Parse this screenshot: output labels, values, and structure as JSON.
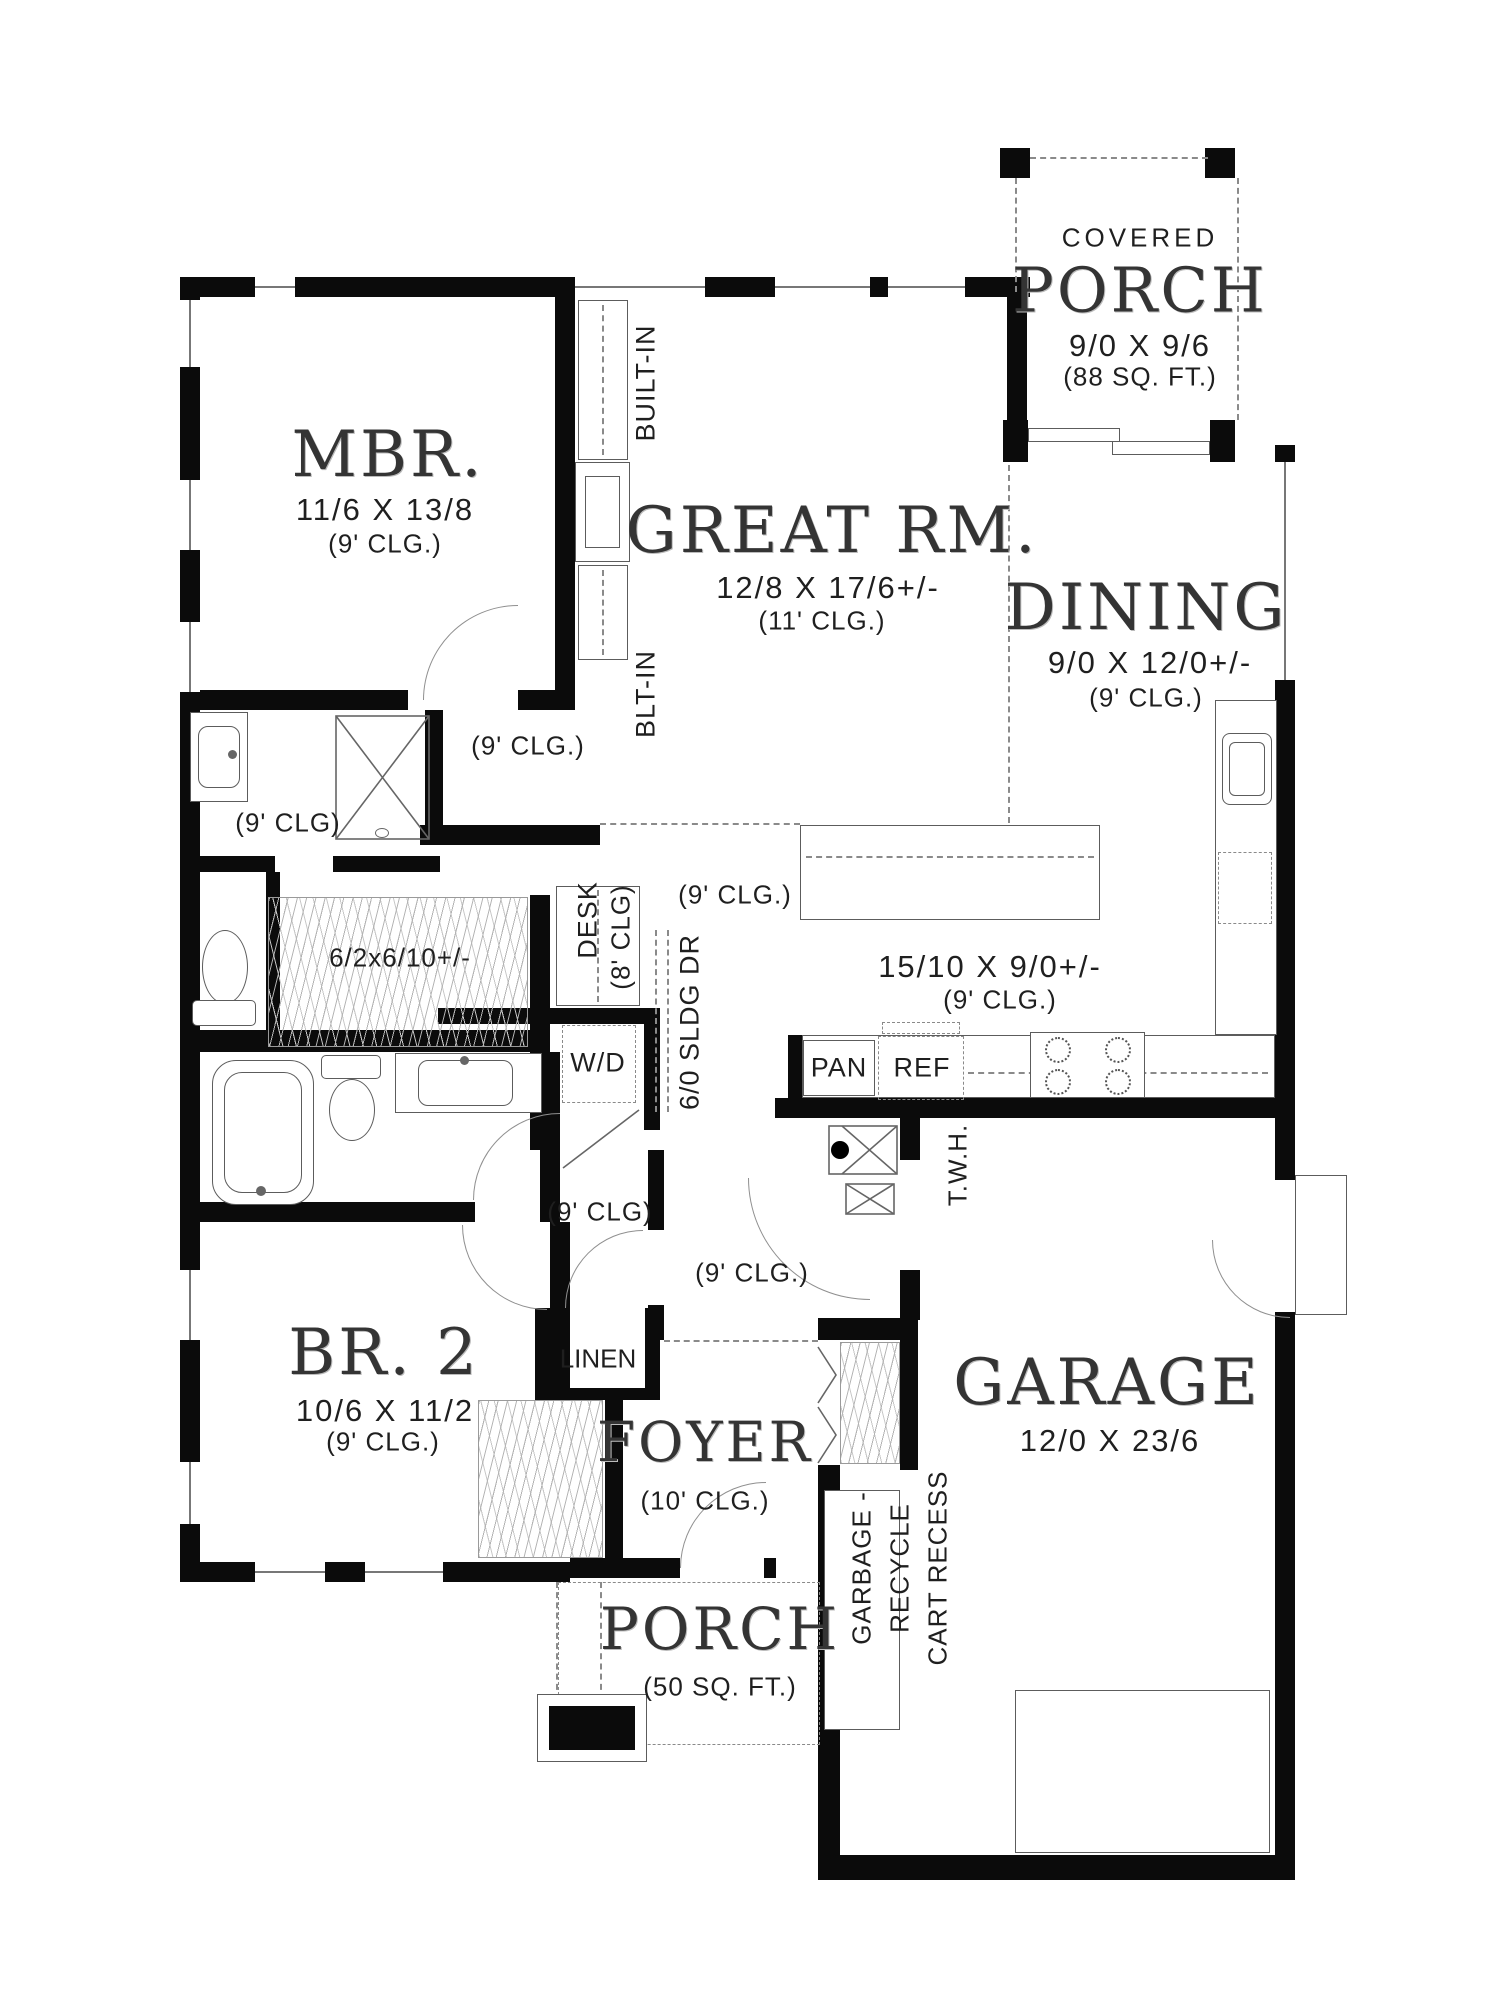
{
  "plan": {
    "type": "architectural-floor-plan",
    "rooms": {
      "covered_porch": {
        "label_top": "COVERED",
        "name": "PORCH",
        "dims": "9/0 X 9/6",
        "area": "(88 SQ. FT.)"
      },
      "mbr": {
        "name": "MBR.",
        "dims": "11/6 X 13/8",
        "clg": "(9' CLG.)"
      },
      "great_rm": {
        "name": "GREAT RM.",
        "dims": "12/8 X 17/6+/-",
        "clg": "(11' CLG.)"
      },
      "dining": {
        "name": "DINING",
        "dims": "9/0 X 12/0+/-",
        "clg": "(9' CLG.)"
      },
      "kitchen": {
        "dims": "15/10 X 9/0+/-",
        "clg": "(9' CLG.)"
      },
      "br2": {
        "name": "BR. 2",
        "dims": "10/6 X 11/2",
        "clg": "(9' CLG.)"
      },
      "foyer": {
        "name": "FOYER",
        "clg": "(10' CLG.)"
      },
      "garage": {
        "name": "GARAGE",
        "dims": "12/0 X 23/6"
      },
      "porch": {
        "name": "PORCH",
        "area": "(50 SQ. FT.)"
      }
    },
    "labels": {
      "built_in": "BUILT-IN",
      "blt_in": "BLT-IN",
      "desk": "DESK",
      "desk_clg": "(8' CLG)",
      "sliding_door": "6/0 SLDG DR",
      "washer_dryer": "W/D",
      "pantry": "PAN",
      "fridge": "REF",
      "water_heater": "T.W.H.",
      "linen": "LINEN",
      "mbr_closet_dims": "6/2x6/10+/-",
      "clg_9": "(9' CLG.)",
      "clg_9_alt": "(9' CLG)",
      "garbage_line1": "GARBAGE -",
      "garbage_line2": "RECYCLE",
      "garbage_line3": "CART RECESS"
    },
    "colors": {
      "wall": "#0b0b0b",
      "line": "#5c5c5c",
      "dash": "#8a8a8a",
      "text": "#1f1f1f"
    }
  }
}
